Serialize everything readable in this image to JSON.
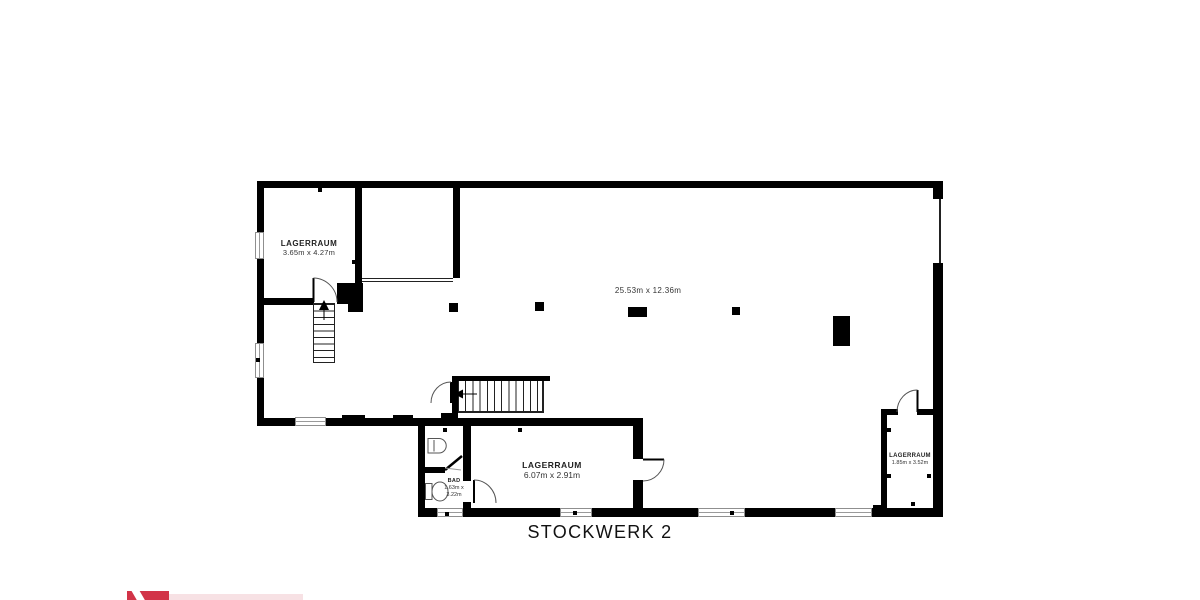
{
  "floorplan": {
    "title": "STOCKWERK 2",
    "hall_dimensions": "25.53m x 12.36m",
    "rooms": {
      "storage_top_left": {
        "label": "LAGERRAUM",
        "dimensions": "3.65m x 4.27m"
      },
      "storage_bottom": {
        "label": "LAGERRAUM",
        "dimensions": "6.07m x 2.91m"
      },
      "bathroom": {
        "label": "BAD",
        "dimensions_line1": "1.63m x",
        "dimensions_line2": "3.22m"
      },
      "storage_right": {
        "label": "LAGERRAUM",
        "dimensions": "1.85m x 3.52m"
      }
    }
  },
  "colors": {
    "wall": "#000000",
    "text": "#222222",
    "logo_red": "#d23448",
    "logo_pink_band": "#f7e1e4"
  }
}
